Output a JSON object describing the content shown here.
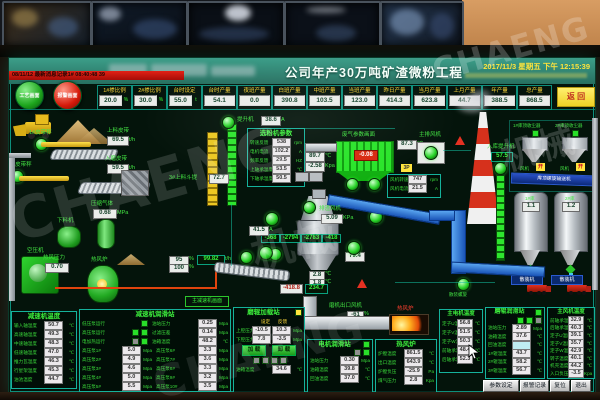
{
  "brand": {
    "wm1": "CHAENG",
    "wm2": "机械"
  },
  "header": {
    "title": "公司年产30万吨矿渣微粉工程",
    "date": "2017/11/3 星期五 下午 12:15:39",
    "alarm": "08/11/12 最新消息记录1#  08:40:48  39",
    "btn_process": "工艺画面",
    "btn_alarm": "报警画面",
    "btn_return": "返 回"
  },
  "stats": [
    {
      "l": "1#掺比例",
      "v": "20.0",
      "u": "%"
    },
    {
      "l": "2#掺比例",
      "v": "30.0",
      "u": "%"
    },
    {
      "l": "台时设定",
      "v": "55.0",
      "u": "t"
    },
    {
      "l": "台时产量",
      "v": "54.1",
      "u": ""
    },
    {
      "l": "夜班产量",
      "v": "0.0",
      "u": ""
    },
    {
      "l": "白班产量",
      "v": "390.8",
      "u": ""
    },
    {
      "l": "中班产量",
      "v": "103.5",
      "u": ""
    },
    {
      "l": "当班产量",
      "v": "123.0",
      "u": ""
    },
    {
      "l": "昨日产量",
      "v": "414.3",
      "u": ""
    },
    {
      "l": "当月产量",
      "v": "623.8",
      "u": ""
    },
    {
      "l": "上月产量",
      "v": "44.7",
      "u": ""
    },
    {
      "l": "年产量",
      "v": "388.5",
      "u": ""
    },
    {
      "l": "总产量",
      "v": "868.5",
      "u": ""
    }
  ],
  "mimic": {
    "belt1": {
      "l": "1#皮带秤",
      "v": "69.5",
      "u": "t/h",
      "feed": "上料皮带"
    },
    "belt2": {
      "l": "2#皮带秤",
      "v": "59.5",
      "u": "t/h",
      "feed": "入磨皮带"
    },
    "valve1": "95",
    "valve2": "100",
    "pct": "%",
    "total": "99.82",
    "total_u": "t/h",
    "aircomp": "空压机",
    "feeder": "下料机",
    "gas": {
      "l": "压缩气体",
      "v": "0.68",
      "u": "MPa"
    },
    "stove": {
      "l": "热风炉",
      "pl": "热风压力",
      "pv": "0.70"
    },
    "hoist": {
      "l": "提升机",
      "v": "38.6",
      "u": "A"
    },
    "hoist2": {
      "l": "3#上料斗提",
      "v": "72.7"
    },
    "mill_current": {
      "v": "41.5",
      "u": "A"
    },
    "classifier": {
      "t": "选粉机参数",
      "rows": [
        {
          "l": "转速反馈",
          "v": "538",
          "u": "rpm"
        },
        {
          "l": "电机电流",
          "v": "102.2",
          "u": "A"
        },
        {
          "l": "频率反馈",
          "v": "29.5",
          "u": "HZ"
        },
        {
          "l": "上轴承温度",
          "v": "53.5",
          "u": "℃"
        },
        {
          "l": "下轴承温度",
          "v": "50.5",
          "u": "℃"
        }
      ]
    },
    "gas_temp": {
      "v": "89.7",
      "u": "℃"
    },
    "gas_press": {
      "v": "-2.58",
      "u": "Kpa"
    },
    "filter": {
      "l": "废气参数画面",
      "v": "-0.08"
    },
    "fan": {
      "l": "主排风机",
      "temp": "87.3",
      "temp_u": "℃",
      "badge": "3P",
      "rows": [
        {
          "l": "风机转速",
          "v": "747",
          "u": "rpm"
        },
        {
          "l": "风机电流",
          "v": "21.5",
          "u": "A"
        }
      ]
    },
    "slagfan": {
      "l": "排渣风机",
      "v": "5.09",
      "u": "KPa"
    },
    "mill": {
      "p1": "-368",
      "p2": "-2794",
      "p3": "-2783",
      "p4": "-418",
      "side": "79.4",
      "v1": "2.8",
      "v1u": "℃",
      "v2": "1.8",
      "v2u": "℃",
      "o1": "-418.8",
      "o2": "234.7"
    },
    "outfan": {
      "l": "磨机出口风机",
      "v1": "-61",
      "v2": "-0",
      "u": "%"
    },
    "flame": {
      "l": "热风炉"
    },
    "navbox": "主减速机画面",
    "inhoist": {
      "l": "入库提升机",
      "v": "57.5"
    },
    "cyc1": "1#库顶收尘器",
    "cyc2": "2#库顶收尘器",
    "fanw": "风机",
    "on": "开",
    "screw": "库顶螺旋输送机",
    "silo1": {
      "l": "1#库",
      "v": "1.1"
    },
    "silo2": {
      "l": "2#库",
      "v": "1.2"
    },
    "bulk": "散装机",
    "bulk_screw": "散装螺旋"
  },
  "panels": {
    "p1": {
      "t": "减速机温度",
      "rows": [
        {
          "l": "输入轴温度",
          "v": "50.7",
          "u": "℃"
        },
        {
          "l": "高速轴温度",
          "v": "49.3",
          "u": "℃"
        },
        {
          "l": "中速轴温度",
          "v": "48.3",
          "u": "℃"
        },
        {
          "l": "低速轴温度",
          "v": "47.0",
          "u": "℃"
        },
        {
          "l": "推力瓦温度",
          "v": "46.3",
          "u": "℃"
        },
        {
          "l": "行星架温度",
          "v": "45.3",
          "u": "℃"
        },
        {
          "l": "油池温度",
          "v": "44.7",
          "u": "℃"
        }
      ]
    },
    "p2": {
      "t": "减速机润滑站",
      "ind": [
        {
          "l": "低压泵运行"
        },
        {
          "l": "高压泵运行"
        },
        {
          "l": "电加热运行"
        }
      ],
      "mini": [
        {
          "l": "油站压力",
          "v": "0.25",
          "u": "Mpa"
        },
        {
          "l": "过滤压差",
          "v": "0.14",
          "u": "Mpa"
        },
        {
          "l": "油箱温度",
          "v": "48.2",
          "u": "℃"
        }
      ],
      "ra": [
        {
          "l": "高压泵1#",
          "v": "5.0",
          "u": "Mpa"
        },
        {
          "l": "高压泵2#",
          "v": "4.9",
          "u": "Mpa"
        },
        {
          "l": "高压泵3#",
          "v": "4.6",
          "u": "Mpa"
        },
        {
          "l": "高压泵4#",
          "v": "5.0",
          "u": "Mpa"
        },
        {
          "l": "高压泵5#",
          "v": "5.5",
          "u": "Mpa"
        }
      ],
      "rb": [
        {
          "l": "高压泵6#",
          "v": "3.3",
          "u": "Mpa"
        },
        {
          "l": "高压泵7#",
          "v": "3.6",
          "u": "Mpa"
        },
        {
          "l": "高压泵8#",
          "v": "3.3",
          "u": "Mpa"
        },
        {
          "l": "高压泵9#",
          "v": "3.2",
          "u": "Mpa"
        },
        {
          "l": "高压泵10#",
          "v": "3.5",
          "u": "Mpa"
        }
      ]
    },
    "p3": {
      "t": "磨辊加载站",
      "h1": "设定",
      "h2": "反馈",
      "r1l": "上腔压力",
      "r1a": "-10.5",
      "r1b": "10.3",
      "r2l": "下腔压力",
      "r2a": "7.8",
      "r2b": "-3.5",
      "u": "Mpa",
      "b1": "加 载",
      "b2": "卸 载",
      "tl": "油箱温度",
      "tv": "34.6",
      "tu": "℃"
    },
    "p4": {
      "t": "电机润滑站",
      "rows": [
        {
          "l": "油站压力",
          "v": "0.30",
          "u": "Mpa"
        },
        {
          "l": "油箱温度",
          "v": "39.8",
          "u": "℃"
        },
        {
          "l": "回油温度",
          "v": "37.0",
          "u": "℃"
        }
      ]
    },
    "p5": {
      "t": "热风炉",
      "rows": [
        {
          "l": "炉膛温度",
          "v": "861.5",
          "u": "℃"
        },
        {
          "l": "出口温度",
          "v": "643.9",
          "u": "℃"
        },
        {
          "l": "炉膛负压",
          "v": "-25.9",
          "u": "Pa"
        },
        {
          "l": "煤气压力",
          "v": "2.8",
          "u": "Kpa"
        }
      ]
    },
    "p6": {
      "t": "主电机温度",
      "rows": [
        {
          "l": "定子U温度",
          "v": "56.8",
          "u": "℃"
        },
        {
          "l": "定子V温度",
          "v": "51.5",
          "u": "℃"
        },
        {
          "l": "定子W温度",
          "v": "50.3",
          "u": "℃"
        },
        {
          "l": "前轴承温度",
          "v": "48.4",
          "u": "℃"
        },
        {
          "l": "后轴承温度",
          "v": "52.3",
          "u": "℃"
        }
      ]
    },
    "p7": {
      "t": "磨辊润滑站",
      "rows": [
        {
          "l": "油站压力",
          "v": "2.89",
          "u": "Mpa"
        },
        {
          "l": "油箱温度",
          "v": "37.6",
          "u": "℃"
        },
        {
          "l": "回油温度",
          "v": "",
          "u": "℃"
        },
        {
          "l": "1#辊温度",
          "v": "43.7",
          "u": "℃"
        },
        {
          "l": "2#辊温度",
          "v": "58.2",
          "u": "℃"
        },
        {
          "l": "3#辊温度",
          "v": "56.7",
          "u": "℃"
        }
      ]
    },
    "p8": {
      "t": "主风机温度",
      "rows": [
        {
          "l": "前轴承温度",
          "v": "32.9",
          "u": "℃"
        },
        {
          "l": "后轴承温度",
          "v": "40.3",
          "u": "℃"
        },
        {
          "l": "定子U温度",
          "v": "39.1",
          "u": "℃"
        },
        {
          "l": "定子V温度",
          "v": "35.7",
          "u": "℃"
        },
        {
          "l": "定子W温度",
          "v": "42.9",
          "u": "℃"
        },
        {
          "l": "转子温度",
          "v": "40.1",
          "u": "℃"
        },
        {
          "l": "机壳温度",
          "v": "44.2",
          "u": "℃"
        },
        {
          "l": "入口负压",
          "v": "-3.5",
          "u": "Kpa"
        }
      ]
    }
  },
  "footer": {
    "b1": "参数设定",
    "b2": "报警记录",
    "b3": "复位",
    "b4": "退出"
  }
}
